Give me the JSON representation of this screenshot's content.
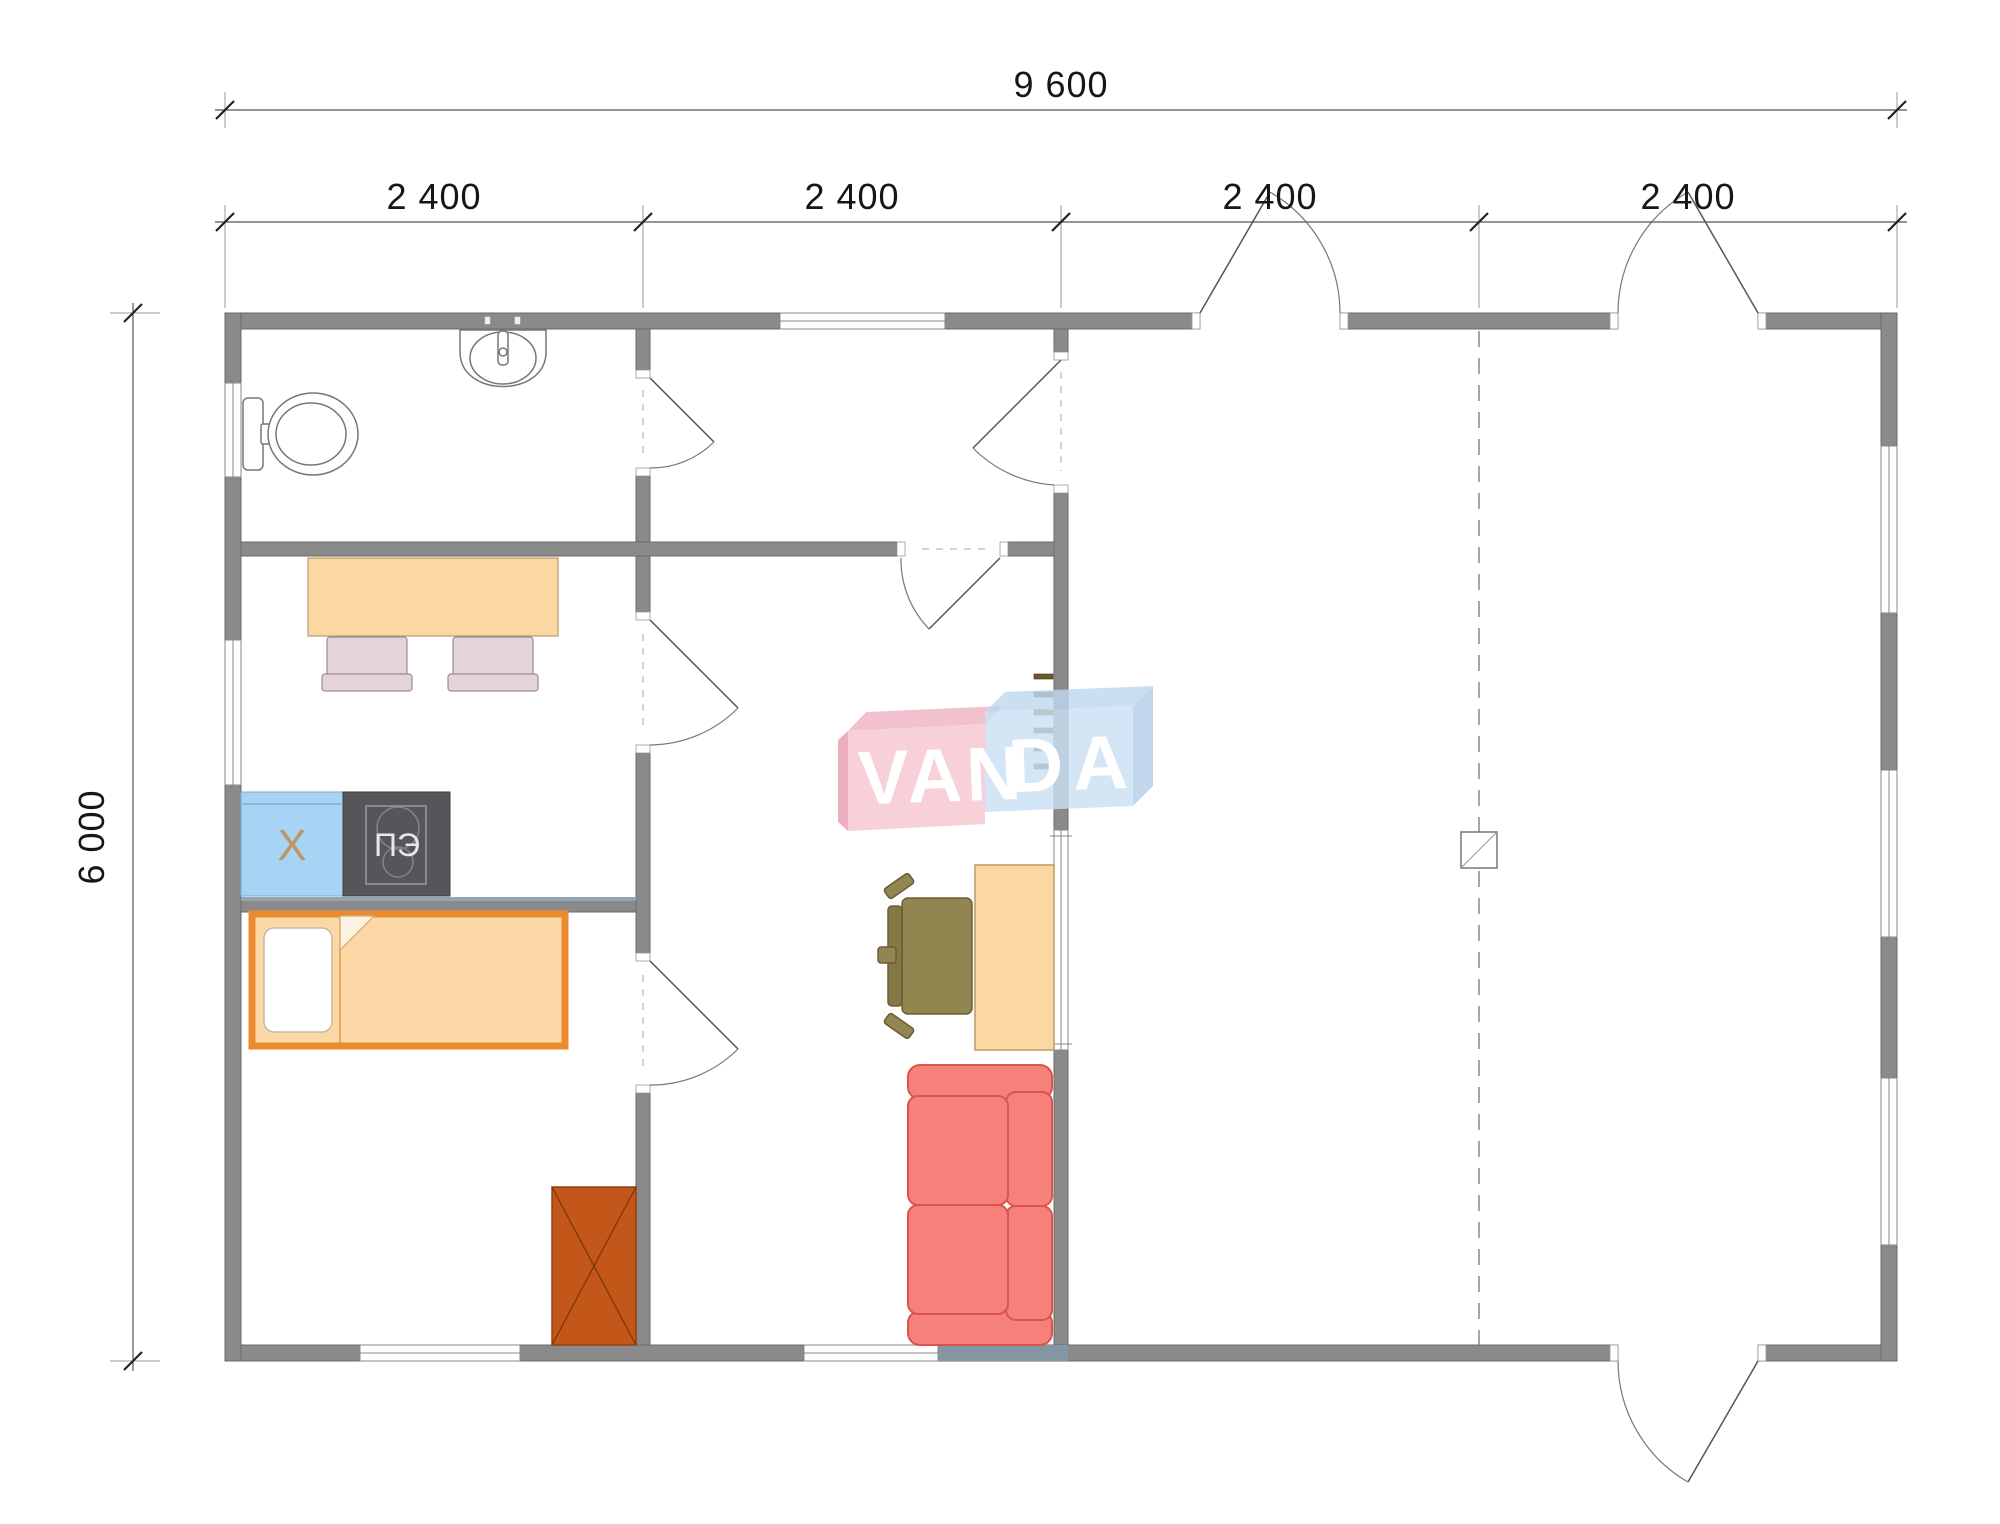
{
  "dimensions": {
    "overall_width": "9 600",
    "overall_depth": "6 000",
    "modules": [
      "2 400",
      "2 400",
      "2 400",
      "2 400"
    ]
  },
  "appliances": {
    "fridge_label": "X",
    "stove_label": "ПЭ"
  },
  "watermark": {
    "part1": "VAN",
    "part2": "DA"
  },
  "colors": {
    "wall": "#8A8A8A",
    "wall_outline": "#6A6A6A",
    "fridge": "#A7D3F4",
    "fridge_letter": "#BD9663",
    "stove": "#56555A",
    "wood_furniture": "#FBD7A1",
    "bed_frame": "#EC8A30",
    "sofa": "#F5817A",
    "sofa_outline": "#D9544B",
    "cabinet": "#C35719",
    "chair": "#E5D3DB",
    "office_chair": "#93854F",
    "logo_pink": "#F6CAD3",
    "logo_blue": "#CBE1F4"
  }
}
